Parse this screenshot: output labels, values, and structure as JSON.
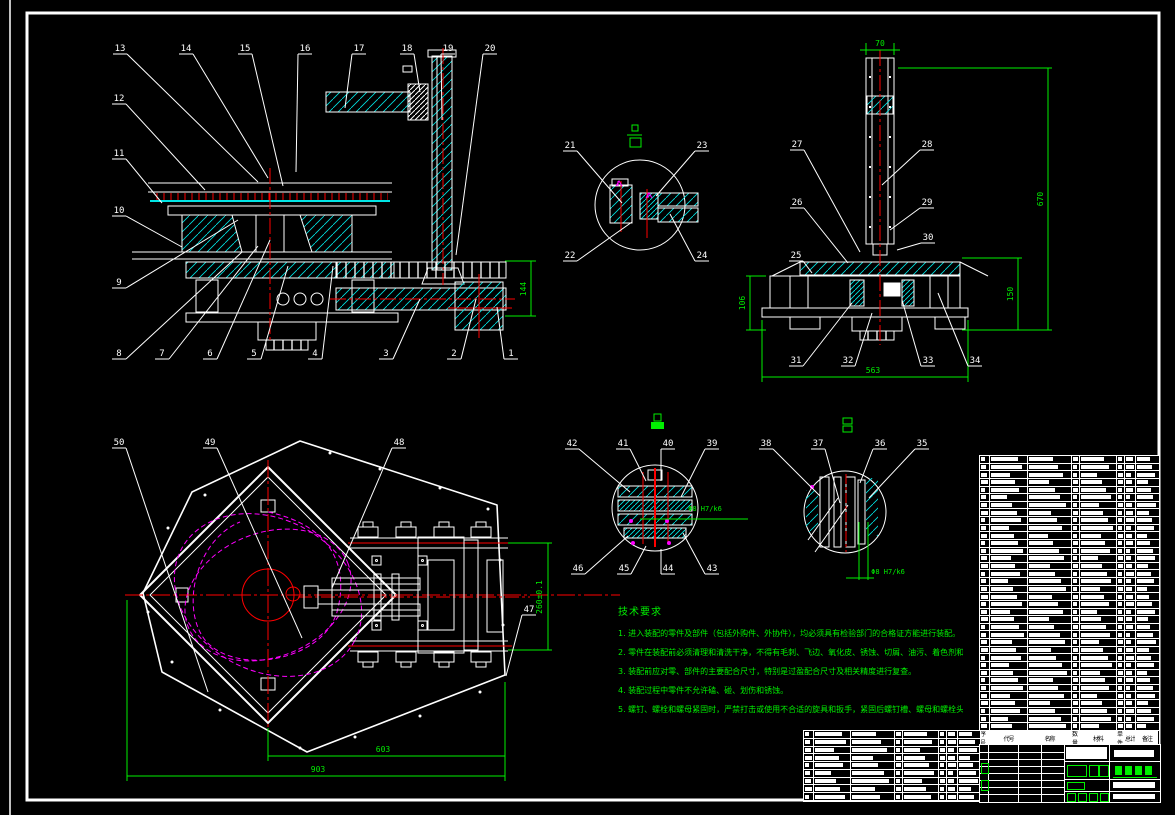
{
  "sheet": {
    "kind": "CAD assembly drawing",
    "background": "#000000",
    "colors": {
      "line": "#ffffff",
      "hatch": "#00e5e5",
      "centerline": "#ff0000",
      "cam": "#ff00ff",
      "annotation": "#00ef00"
    }
  },
  "callouts": [
    {
      "n": "13",
      "x": 120,
      "y": 50,
      "tx": 258,
      "ty": 182
    },
    {
      "n": "14",
      "x": 186,
      "y": 50,
      "tx": 268,
      "ty": 178
    },
    {
      "n": "15",
      "x": 245,
      "y": 50,
      "tx": 283,
      "ty": 186
    },
    {
      "n": "16",
      "x": 305,
      "y": 50,
      "tx": 296,
      "ty": 172
    },
    {
      "n": "17",
      "x": 359,
      "y": 50,
      "tx": 345,
      "ty": 108
    },
    {
      "n": "18",
      "x": 407,
      "y": 50,
      "tx": 420,
      "ty": 92
    },
    {
      "n": "19",
      "x": 448,
      "y": 50,
      "tx": 442,
      "ty": 120
    },
    {
      "n": "20",
      "x": 490,
      "y": 50,
      "tx": 456,
      "ty": 255
    },
    {
      "n": "12",
      "x": 119,
      "y": 100,
      "tx": 205,
      "ty": 190
    },
    {
      "n": "11",
      "x": 119,
      "y": 155,
      "tx": 162,
      "ty": 203
    },
    {
      "n": "10",
      "x": 119,
      "y": 212,
      "tx": 182,
      "ty": 247
    },
    {
      "n": "9",
      "x": 119,
      "y": 284,
      "tx": 238,
      "ty": 220
    },
    {
      "n": "8",
      "x": 119,
      "y": 355,
      "tx": 242,
      "ty": 252
    },
    {
      "n": "7",
      "x": 162,
      "y": 355,
      "tx": 258,
      "ty": 246
    },
    {
      "n": "6",
      "x": 210,
      "y": 355,
      "tx": 270,
      "ty": 240
    },
    {
      "n": "5",
      "x": 254,
      "y": 355,
      "tx": 288,
      "ty": 266
    },
    {
      "n": "4",
      "x": 315,
      "y": 355,
      "tx": 333,
      "ty": 266
    },
    {
      "n": "3",
      "x": 386,
      "y": 355,
      "tx": 420,
      "ty": 299
    },
    {
      "n": "2",
      "x": 454,
      "y": 355,
      "tx": 476,
      "ty": 299
    },
    {
      "n": "1",
      "x": 511,
      "y": 355,
      "tx": 497,
      "ty": 307
    },
    {
      "n": "21",
      "x": 570,
      "y": 147,
      "tx": 622,
      "ty": 203
    },
    {
      "n": "23",
      "x": 702,
      "y": 147,
      "tx": 656,
      "ty": 196
    },
    {
      "n": "22",
      "x": 570,
      "y": 257,
      "tx": 632,
      "ty": 222
    },
    {
      "n": "24",
      "x": 702,
      "y": 257,
      "tx": 670,
      "ty": 214
    },
    {
      "n": "27",
      "x": 797,
      "y": 146,
      "tx": 860,
      "ty": 252
    },
    {
      "n": "28",
      "x": 927,
      "y": 146,
      "tx": 882,
      "ty": 185
    },
    {
      "n": "26",
      "x": 797,
      "y": 204,
      "tx": 848,
      "ty": 263
    },
    {
      "n": "29",
      "x": 927,
      "y": 204,
      "tx": 890,
      "ty": 230
    },
    {
      "n": "25",
      "x": 796,
      "y": 257,
      "tx": 812,
      "ty": 273
    },
    {
      "n": "30",
      "x": 928,
      "y": 239,
      "tx": 897,
      "ty": 250
    },
    {
      "n": "31",
      "x": 796,
      "y": 362,
      "tx": 852,
      "ty": 303
    },
    {
      "n": "32",
      "x": 848,
      "y": 362,
      "tx": 872,
      "ty": 313
    },
    {
      "n": "33",
      "x": 928,
      "y": 362,
      "tx": 902,
      "ty": 300
    },
    {
      "n": "34",
      "x": 975,
      "y": 362,
      "tx": 938,
      "ty": 293
    },
    {
      "n": "50",
      "x": 119,
      "y": 444,
      "tx": 208,
      "ty": 692
    },
    {
      "n": "49",
      "x": 210,
      "y": 444,
      "tx": 302,
      "ty": 638
    },
    {
      "n": "48",
      "x": 399,
      "y": 444,
      "tx": 332,
      "ty": 588
    },
    {
      "n": "47",
      "x": 529,
      "y": 611,
      "tx": 506,
      "ty": 676
    },
    {
      "n": "42",
      "x": 572,
      "y": 445,
      "tx": 630,
      "ty": 492
    },
    {
      "n": "41",
      "x": 623,
      "y": 445,
      "tx": 646,
      "ty": 481
    },
    {
      "n": "40",
      "x": 668,
      "y": 445,
      "tx": 661,
      "ty": 481
    },
    {
      "n": "39",
      "x": 712,
      "y": 445,
      "tx": 681,
      "ty": 497
    },
    {
      "n": "46",
      "x": 578,
      "y": 570,
      "tx": 628,
      "ty": 536
    },
    {
      "n": "45",
      "x": 624,
      "y": 570,
      "tx": 646,
      "ty": 546
    },
    {
      "n": "44",
      "x": 668,
      "y": 570,
      "tx": 661,
      "ty": 549
    },
    {
      "n": "43",
      "x": 712,
      "y": 570,
      "tx": 683,
      "ty": 533
    },
    {
      "n": "38",
      "x": 766,
      "y": 445,
      "tx": 820,
      "ty": 496
    },
    {
      "n": "37",
      "x": 818,
      "y": 445,
      "tx": 840,
      "ty": 503
    },
    {
      "n": "36",
      "x": 880,
      "y": 445,
      "tx": 860,
      "ty": 483
    },
    {
      "n": "35",
      "x": 922,
      "y": 445,
      "tx": 869,
      "ty": 498
    }
  ],
  "dimensions": [
    {
      "text": "144",
      "x": 526,
      "y": 289,
      "rot": -90,
      "small": false
    },
    {
      "text": "70",
      "x": 880,
      "y": 46,
      "rot": 0,
      "small": false
    },
    {
      "text": "670",
      "x": 1043,
      "y": 199,
      "rot": -90,
      "small": false
    },
    {
      "text": "150",
      "x": 1013,
      "y": 294,
      "rot": -90,
      "small": false
    },
    {
      "text": "106",
      "x": 745,
      "y": 303,
      "rot": -90,
      "small": false
    },
    {
      "text": "563",
      "x": 873,
      "y": 373,
      "rot": 0,
      "small": false
    },
    {
      "text": "603",
      "x": 383,
      "y": 752,
      "rot": 0,
      "small": false
    },
    {
      "text": "903",
      "x": 318,
      "y": 772,
      "rot": 0,
      "small": false
    },
    {
      "text": "260±0.1",
      "x": 542,
      "y": 597,
      "rot": -90,
      "small": false
    },
    {
      "text": "Φ8 H7/k6",
      "x": 705,
      "y": 511,
      "rot": 0,
      "small": true
    },
    {
      "text": "Φ8 H7/k6",
      "x": 888,
      "y": 574,
      "rot": 0,
      "small": true
    }
  ],
  "notes": {
    "title": "技术要求",
    "lines": [
      "1. 进入装配的零件及部件（包括外购件、外协件），均必须具有检验部门的合格证方能进行装配。",
      "2. 零件在装配前必须清理和清洗干净，不得有毛刺、飞边、氧化皮、锈蚀、切屑、油污、着色剂和灰尘等。",
      "3. 装配前应对零、部件的主要配合尺寸，特别是过盈配合尺寸及相关精度进行复查。",
      "4. 装配过程中零件不允许磕、碰、划伤和锈蚀。",
      "5. 螺钉、螺栓和螺母紧固时，严禁打击或使用不合适的旋具和扳手，紧固后螺钉槽、螺母和螺栓头部不得损坏。"
    ]
  },
  "bom": {
    "header": [
      "序号",
      "代号",
      "名称",
      "数量",
      "材料",
      "单件",
      "总计",
      "备注"
    ],
    "col_widths": [
      10,
      38,
      44,
      8,
      37,
      8,
      11,
      23
    ],
    "row_count": 36,
    "extra_row_count": 9
  }
}
